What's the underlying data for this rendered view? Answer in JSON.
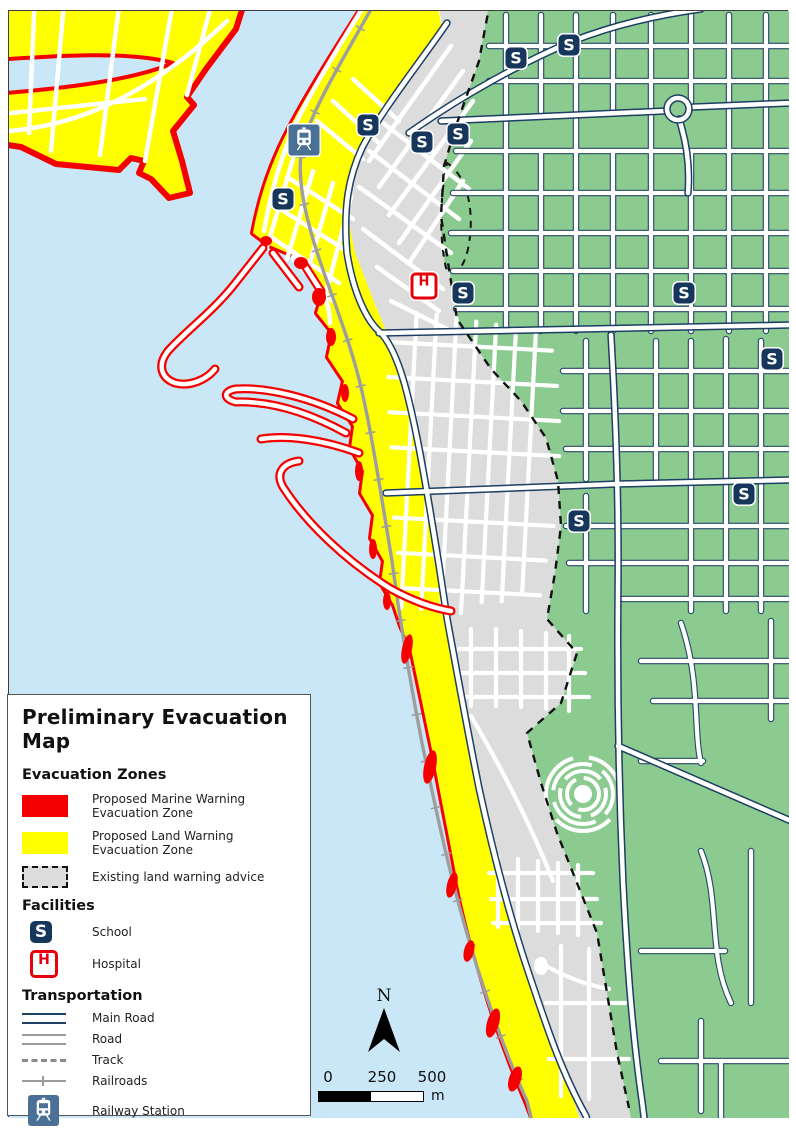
{
  "legend": {
    "title": "Preliminary Evacuation Map",
    "sections": [
      {
        "heading": "Evacuation Zones",
        "items": [
          {
            "symbol": "marine-zone-swatch",
            "label": "Proposed Marine Warning Evacuation Zone"
          },
          {
            "symbol": "land-zone-swatch",
            "label": "Proposed Land Warning Evacuation Zone"
          },
          {
            "symbol": "existing-advice-swatch",
            "label": "Existing land warning advice"
          }
        ]
      },
      {
        "heading": "Facilities",
        "items": [
          {
            "symbol": "school-icon",
            "label": "School"
          },
          {
            "symbol": "hospital-icon",
            "label": "Hospital"
          }
        ]
      },
      {
        "heading": "Transportation",
        "items": [
          {
            "symbol": "main-road-line",
            "label": "Main Road"
          },
          {
            "symbol": "road-line",
            "label": "Road"
          },
          {
            "symbol": "track-line",
            "label": "Track"
          },
          {
            "symbol": "railroad-line",
            "label": "Railroads"
          },
          {
            "symbol": "railway-station-icon",
            "label": "Railway Station"
          }
        ]
      }
    ]
  },
  "north_label": "N",
  "scale_bar": {
    "ticks": [
      "0",
      "250",
      "500"
    ],
    "unit": "m"
  },
  "markers": {
    "school_letter": "S",
    "hospital_letter": "H",
    "schools": [
      [
        515,
        57
      ],
      [
        568,
        44
      ],
      [
        367,
        124
      ],
      [
        421,
        141
      ],
      [
        457,
        133
      ],
      [
        282,
        198
      ],
      [
        462,
        292
      ],
      [
        683,
        292
      ],
      [
        771,
        358
      ],
      [
        743,
        493
      ],
      [
        578,
        520
      ]
    ],
    "hospital": [
      423,
      285
    ],
    "railway_station": [
      303,
      139
    ]
  },
  "colors": {
    "water": "#c9e7f6",
    "vegetation_green": "#8bcb90",
    "urban_gray": "#dcdcdc",
    "land_warning_yellow": "#ffff00",
    "marine_warning_red": "#f50000",
    "main_road_navy": "#1c3f63",
    "school_badge_navy": "#16365c",
    "hospital_red": "#e8000d",
    "station_blue": "#4a7096",
    "railroad_gray": "#9e9e9e"
  }
}
